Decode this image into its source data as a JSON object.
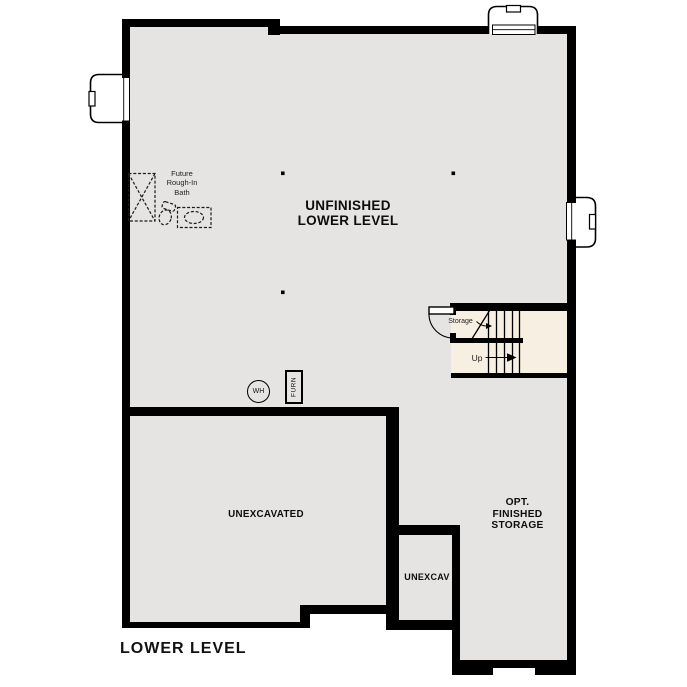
{
  "page": {
    "title": "LOWER LEVEL"
  },
  "rooms": {
    "main": {
      "line1": "UNFINISHED",
      "line2": "LOWER LEVEL"
    },
    "unexcavated": {
      "label": "UNEXCAVATED"
    },
    "unexcav": {
      "label": "UNEXCAV"
    },
    "opt_storage": {
      "line1": "OPT.",
      "line2": "FINISHED",
      "line3": "STORAGE"
    }
  },
  "bath": {
    "line1": "Future",
    "line2": "Rough-In",
    "line3": "Bath"
  },
  "stairs": {
    "storage": "Storage",
    "up": "Up"
  },
  "equipment": {
    "water_heater": "WH",
    "furnace": "FURN"
  },
  "colors": {
    "wall": "#000000",
    "floor_gray": "#e5e4e2",
    "stair_cream": "#f7f0e2",
    "background": "#ffffff"
  }
}
